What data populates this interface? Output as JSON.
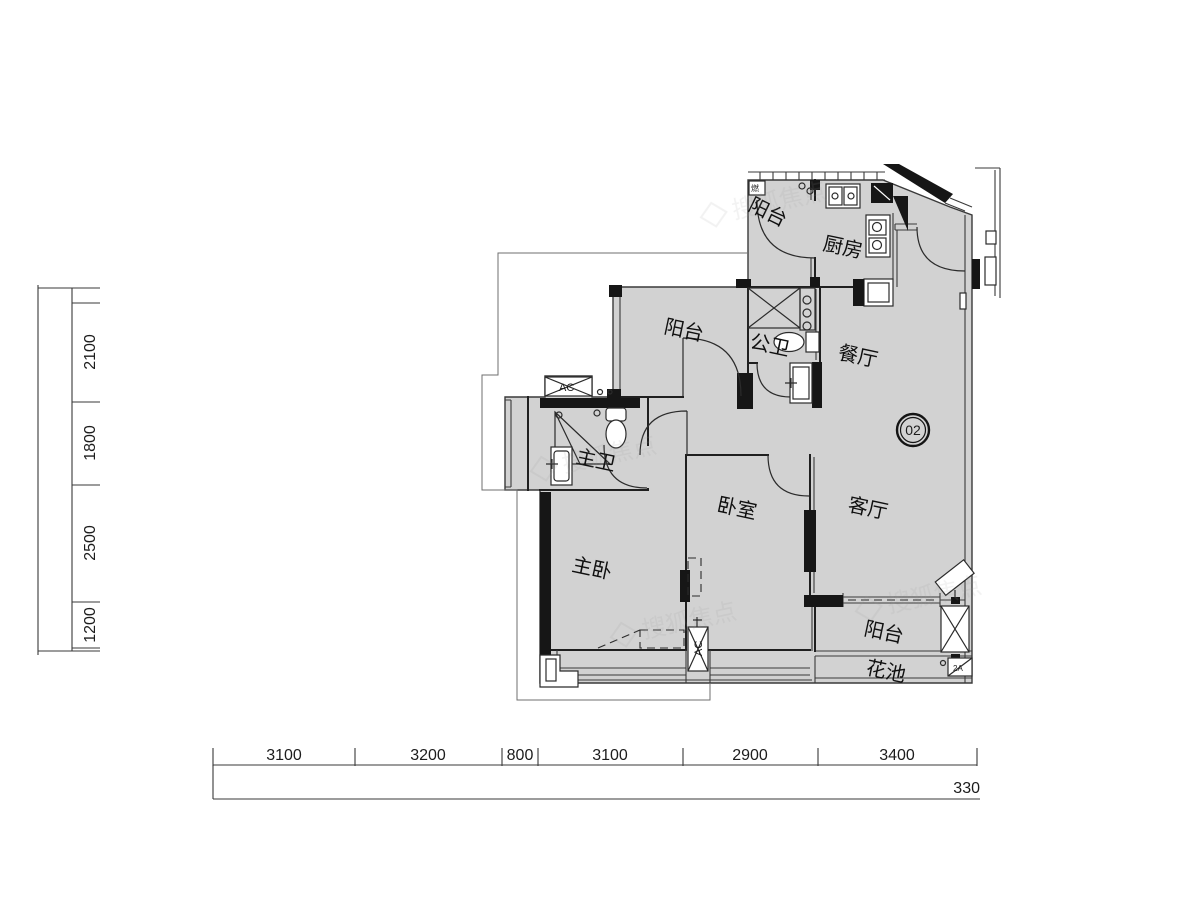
{
  "floorplan": {
    "unit_badge": "02",
    "watermark": {
      "text": "搜狐焦点"
    },
    "rooms": [
      {
        "id": "balcony-top",
        "label": "阳台"
      },
      {
        "id": "kitchen",
        "label": "厨房"
      },
      {
        "id": "balcony-mid",
        "label": "阳台"
      },
      {
        "id": "public-bath",
        "label": "公卫"
      },
      {
        "id": "dining",
        "label": "餐厅"
      },
      {
        "id": "master-bath",
        "label": "主卫"
      },
      {
        "id": "master-bedroom",
        "label": "主卧"
      },
      {
        "id": "bedroom",
        "label": "卧室"
      },
      {
        "id": "living-room",
        "label": "客厅"
      },
      {
        "id": "balcony-bottom",
        "label": "阳台"
      },
      {
        "id": "flower-bed",
        "label": "花池"
      }
    ],
    "equipment": {
      "ac": "AC",
      "ac_code": "2A",
      "gas": "燃"
    },
    "dimensions_bottom": {
      "segments": [
        "3100",
        "3200",
        "800",
        "3100",
        "2900",
        "3400"
      ],
      "total": "330"
    },
    "dimensions_left": {
      "segments": [
        "2100",
        "1800",
        "2500",
        "1200"
      ]
    },
    "colors": {
      "floor": "#d2d2d2",
      "wall": "#1f1f1f",
      "line": "#3a3a3a"
    }
  }
}
